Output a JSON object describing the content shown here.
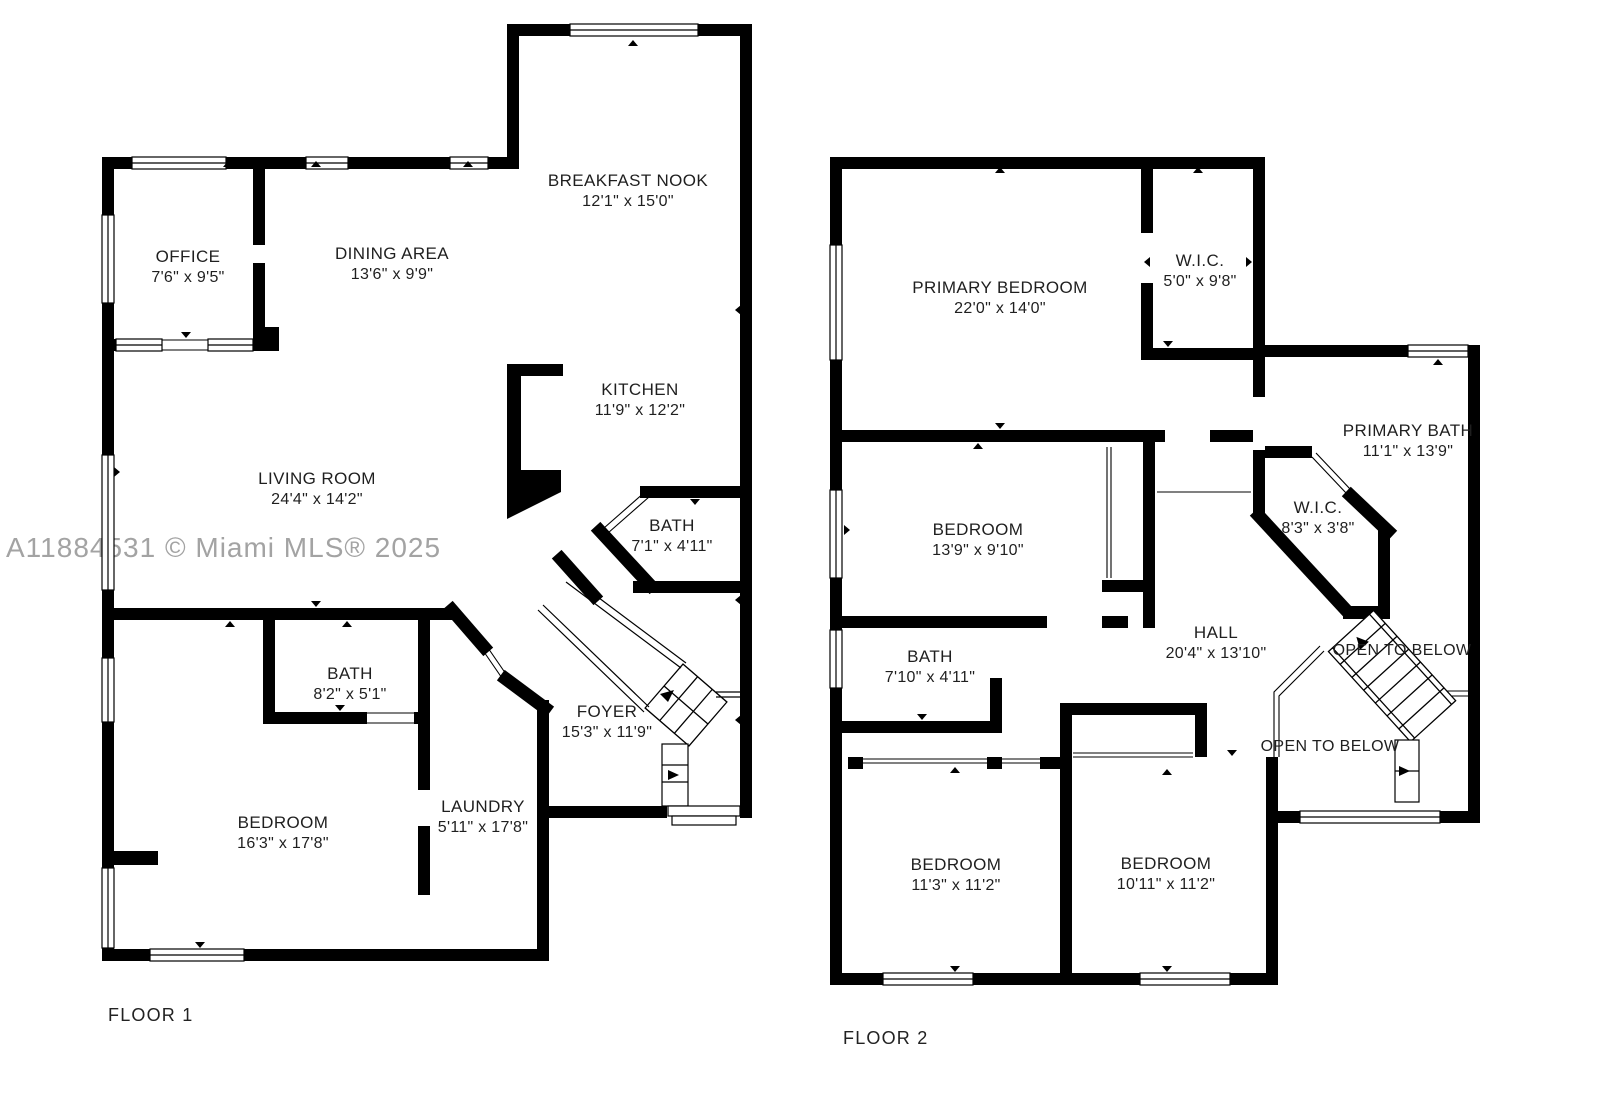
{
  "watermark": "A11884531 © Miami MLS® 2025",
  "colors": {
    "wall": "#000000",
    "text": "#1f1f1f",
    "watermark": "#a3a3a3"
  },
  "floors": [
    {
      "label": "FLOOR 1",
      "rooms": [
        {
          "name": "BREAKFAST NOOK",
          "dims": "12'1\" x 15'0\""
        },
        {
          "name": "OFFICE",
          "dims": "7'6\" x 9'5\""
        },
        {
          "name": "DINING AREA",
          "dims": "13'6\" x 9'9\""
        },
        {
          "name": "KITCHEN",
          "dims": "11'9\" x 12'2\""
        },
        {
          "name": "LIVING ROOM",
          "dims": "24'4\" x 14'2\""
        },
        {
          "name": "BATH",
          "dims": "7'1\" x 4'11\""
        },
        {
          "name": "BATH",
          "dims": "8'2\" x 5'1\""
        },
        {
          "name": "FOYER",
          "dims": "15'3\" x 11'9\""
        },
        {
          "name": "BEDROOM",
          "dims": "16'3\" x 17'8\""
        },
        {
          "name": "LAUNDRY",
          "dims": "5'11\" x 17'8\""
        }
      ]
    },
    {
      "label": "FLOOR 2",
      "rooms": [
        {
          "name": "PRIMARY BEDROOM",
          "dims": "22'0\" x 14'0\""
        },
        {
          "name": "W.I.C.",
          "dims": "5'0\" x 9'8\""
        },
        {
          "name": "PRIMARY BATH",
          "dims": "11'1\" x 13'9\""
        },
        {
          "name": "BEDROOM",
          "dims": "13'9\" x 9'10\""
        },
        {
          "name": "W.I.C.",
          "dims": "8'3\" x 3'8\""
        },
        {
          "name": "BATH",
          "dims": "7'10\" x 4'11\""
        },
        {
          "name": "HALL",
          "dims": "20'4\" x 13'10\""
        },
        {
          "name": "BEDROOM",
          "dims": "11'3\" x 11'2\""
        },
        {
          "name": "BEDROOM",
          "dims": "10'11\" x 11'2\""
        },
        {
          "name": "OPEN TO BELOW",
          "dims": ""
        },
        {
          "name": "OPEN TO BELOW",
          "dims": ""
        }
      ]
    }
  ]
}
